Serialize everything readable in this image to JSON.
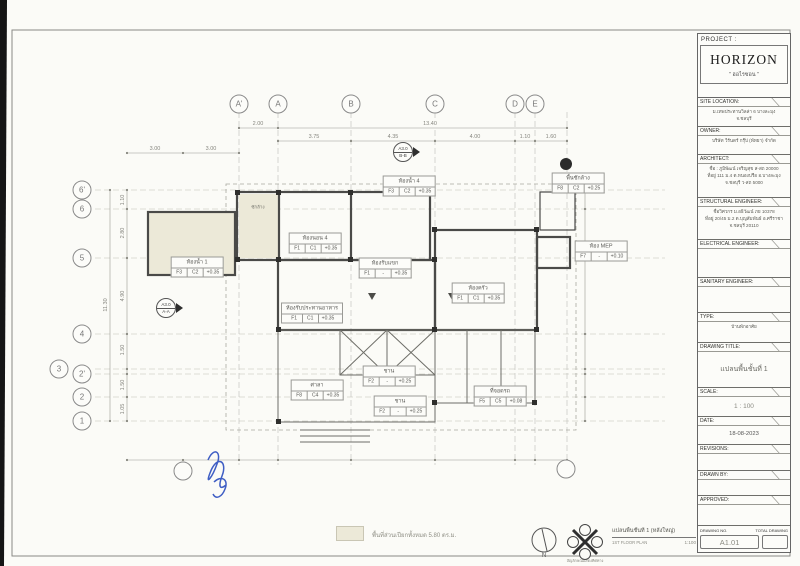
{
  "colors": {
    "paper": "#fbfbf7",
    "line_gray": "#8a8a8a",
    "wall_dark": "#4a4a4a",
    "wet_area_cream": "#ece9d8",
    "signature_blue": "#3f5ec4"
  },
  "title_block": {
    "project_label": "PROJECT :",
    "project_name": "HORIZON",
    "project_name_thai": "\" ฮอไรซอน \"",
    "sections": [
      {
        "label": "SITE LOCATION:",
        "lines": [
          "ม.เทพประทานวิลล่า 6 บางละมุง",
          "จ.ชลบุรี"
        ]
      },
      {
        "label": "OWNER:",
        "lines": [
          "บริษัท วีรันดร์ กรุ๊ป (พัทยา) จำกัด"
        ]
      },
      {
        "label": "ARCHITECT:",
        "lines": [
          "ชื่อ : ภูมิพัฒน์ เจริญสุข ส-สถ 20000",
          "ที่อยู่ 111 ม.4 ต.หนองปรือ อ.บางละมุง",
          "จ.ชลบุรี ว-สถ 5000"
        ]
      },
      {
        "label": "STRUCTURAL ENGINEER:",
        "lines": [
          "ชื่อวิศวกร ม.อธิวัฒน์ ภย 10378",
          "ที่อยู่ 20/45 ม.2 ต.บุญสัมพันธ์ อ.ศรีราชา",
          "จ.ชลบุรี 20110"
        ]
      },
      {
        "label": "ELECTRICAL ENGINEER:",
        "lines": []
      },
      {
        "label": "SANITARY ENGINEER:",
        "lines": []
      },
      {
        "label": "TYPE:",
        "lines": [
          "บ้านพักอาศัย"
        ]
      },
      {
        "label": "DRAWING TITLE:",
        "lines": [
          "แปลนพื้นชั้นที่ 1"
        ]
      },
      {
        "label": "SCALE:",
        "lines": [
          "1 : 100"
        ]
      },
      {
        "label": "DATE:",
        "lines": [
          "18-08-2023"
        ]
      },
      {
        "label": "REVISIONS:",
        "lines": []
      },
      {
        "label": "DRAWN BY:",
        "lines": []
      },
      {
        "label": "APPROVED:",
        "lines": []
      }
    ],
    "footer": {
      "drawing_no_label": "DRAWING NO.",
      "total_drawing_label": "TOTAL DRAWING",
      "drawing_no": "A1.01",
      "total_drawing": ""
    }
  },
  "plan": {
    "grid": {
      "columns": [
        {
          "label": "A'",
          "x": 239
        },
        {
          "label": "A",
          "x": 278
        },
        {
          "label": "B",
          "x": 351
        },
        {
          "label": "C",
          "x": 435
        },
        {
          "label": "D",
          "x": 515
        },
        {
          "label": "E",
          "x": 535
        }
      ],
      "rows": [
        {
          "label": "6'",
          "x": 82,
          "y": 190
        },
        {
          "label": "6",
          "x": 82,
          "y": 209
        },
        {
          "label": "5",
          "x": 82,
          "y": 258
        },
        {
          "label": "4",
          "x": 82,
          "y": 334
        },
        {
          "label": "3",
          "x": 59,
          "y": 369
        },
        {
          "label": "2'",
          "x": 82,
          "y": 374
        },
        {
          "label": "2",
          "x": 82,
          "y": 397
        },
        {
          "label": "1",
          "x": 82,
          "y": 421
        }
      ],
      "extra_bubbles": [
        {
          "label": "",
          "x": 183,
          "y": 471
        },
        {
          "label": "",
          "x": 566,
          "y": 469
        }
      ]
    },
    "dimensions": [
      {
        "label": "2.00",
        "x": 258,
        "y": 124,
        "rot": false
      },
      {
        "label": "13.40",
        "x": 430,
        "y": 124,
        "rot": false
      },
      {
        "label": "3.75",
        "x": 314,
        "y": 137,
        "rot": false
      },
      {
        "label": "4.35",
        "x": 393,
        "y": 137,
        "rot": false
      },
      {
        "label": "4.00",
        "x": 475,
        "y": 137,
        "rot": false
      },
      {
        "label": "1.10",
        "x": 525,
        "y": 137,
        "rot": false
      },
      {
        "label": "1.60",
        "x": 551,
        "y": 137,
        "rot": false
      },
      {
        "label": "3.00",
        "x": 155,
        "y": 149,
        "rot": false
      },
      {
        "label": "3.00",
        "x": 211,
        "y": 149,
        "rot": false
      },
      {
        "label": "1.10",
        "x": 123,
        "y": 200,
        "rot": true
      },
      {
        "label": "2.80",
        "x": 123,
        "y": 233,
        "rot": true
      },
      {
        "label": "4.90",
        "x": 123,
        "y": 296,
        "rot": true
      },
      {
        "label": "1.50",
        "x": 123,
        "y": 350,
        "rot": true
      },
      {
        "label": "1.50",
        "x": 123,
        "y": 385,
        "rot": true
      },
      {
        "label": "1.05",
        "x": 123,
        "y": 409,
        "rot": true
      },
      {
        "label": "11.30",
        "x": 106,
        "y": 305,
        "rot": true
      }
    ],
    "rooms": [
      {
        "name": "ห้องน้ำ 4",
        "floor": "F3",
        "ceiling": "C2",
        "level": "+0.35",
        "x": 409,
        "y": 186
      },
      {
        "name": "พื้นซักล้าง",
        "floor": "F8",
        "ceiling": "C2",
        "level": "+0.25",
        "x": 578,
        "y": 183
      },
      {
        "name": "ห้องนอน 4",
        "floor": "F1",
        "ceiling": "C1",
        "level": "+0.35",
        "x": 315,
        "y": 243
      },
      {
        "name": "ห้องน้ำ 1",
        "floor": "F3",
        "ceiling": "C2",
        "level": "+0.35",
        "x": 197,
        "y": 267
      },
      {
        "name": "ห้องรับแขก",
        "floor": "F1",
        "ceiling": "-",
        "level": "+0.35",
        "x": 385,
        "y": 268
      },
      {
        "name": "ห้อง MEP",
        "floor": "F7",
        "ceiling": "-",
        "level": "+0.10",
        "x": 601,
        "y": 251
      },
      {
        "name": "ห้องครัว",
        "floor": "F1",
        "ceiling": "C1",
        "level": "+0.35",
        "x": 478,
        "y": 293
      },
      {
        "name": "ห้องรับประทานอาหาร",
        "floor": "F1",
        "ceiling": "C1",
        "level": "+0.35",
        "x": 312,
        "y": 313
      },
      {
        "name": "ศาลา",
        "floor": "F8",
        "ceiling": "C4",
        "level": "+0.35",
        "x": 317,
        "y": 390
      },
      {
        "name": "ชาน",
        "floor": "F2",
        "ceiling": "-",
        "level": "+0.25",
        "x": 389,
        "y": 376
      },
      {
        "name": "ชาน",
        "floor": "F2",
        "ceiling": "-",
        "level": "+0.25",
        "x": 400,
        "y": 406
      },
      {
        "name": "ที่จอดรถ",
        "floor": "F5",
        "ceiling": "C5",
        "level": "+0.08",
        "x": 500,
        "y": 396
      }
    ],
    "annotations": {
      "texts": [
        {
          "text": "ซักล้าง",
          "x": 258,
          "y": 207
        }
      ],
      "section_markers": [
        {
          "sheet": "A3.0",
          "section": "A-A",
          "x": 166,
          "y": 308
        },
        {
          "sheet": "A3.0",
          "section": "B-B",
          "x": 403,
          "y": 152
        }
      ]
    }
  },
  "footer": {
    "legend_text": "พื้นที่ส่วนเปียกทั้งหมด 5.80 ตร.ม.",
    "plan_title_thai": "แปลนพื้นชั้นที่ 1 (หลังใหญ่)",
    "plan_title_eng": "1ST FLOOR PLAN",
    "plan_scale": "1:100",
    "north_label": "N",
    "compass_caption": "สัญลักษณ์แสดงทิศทาง"
  }
}
